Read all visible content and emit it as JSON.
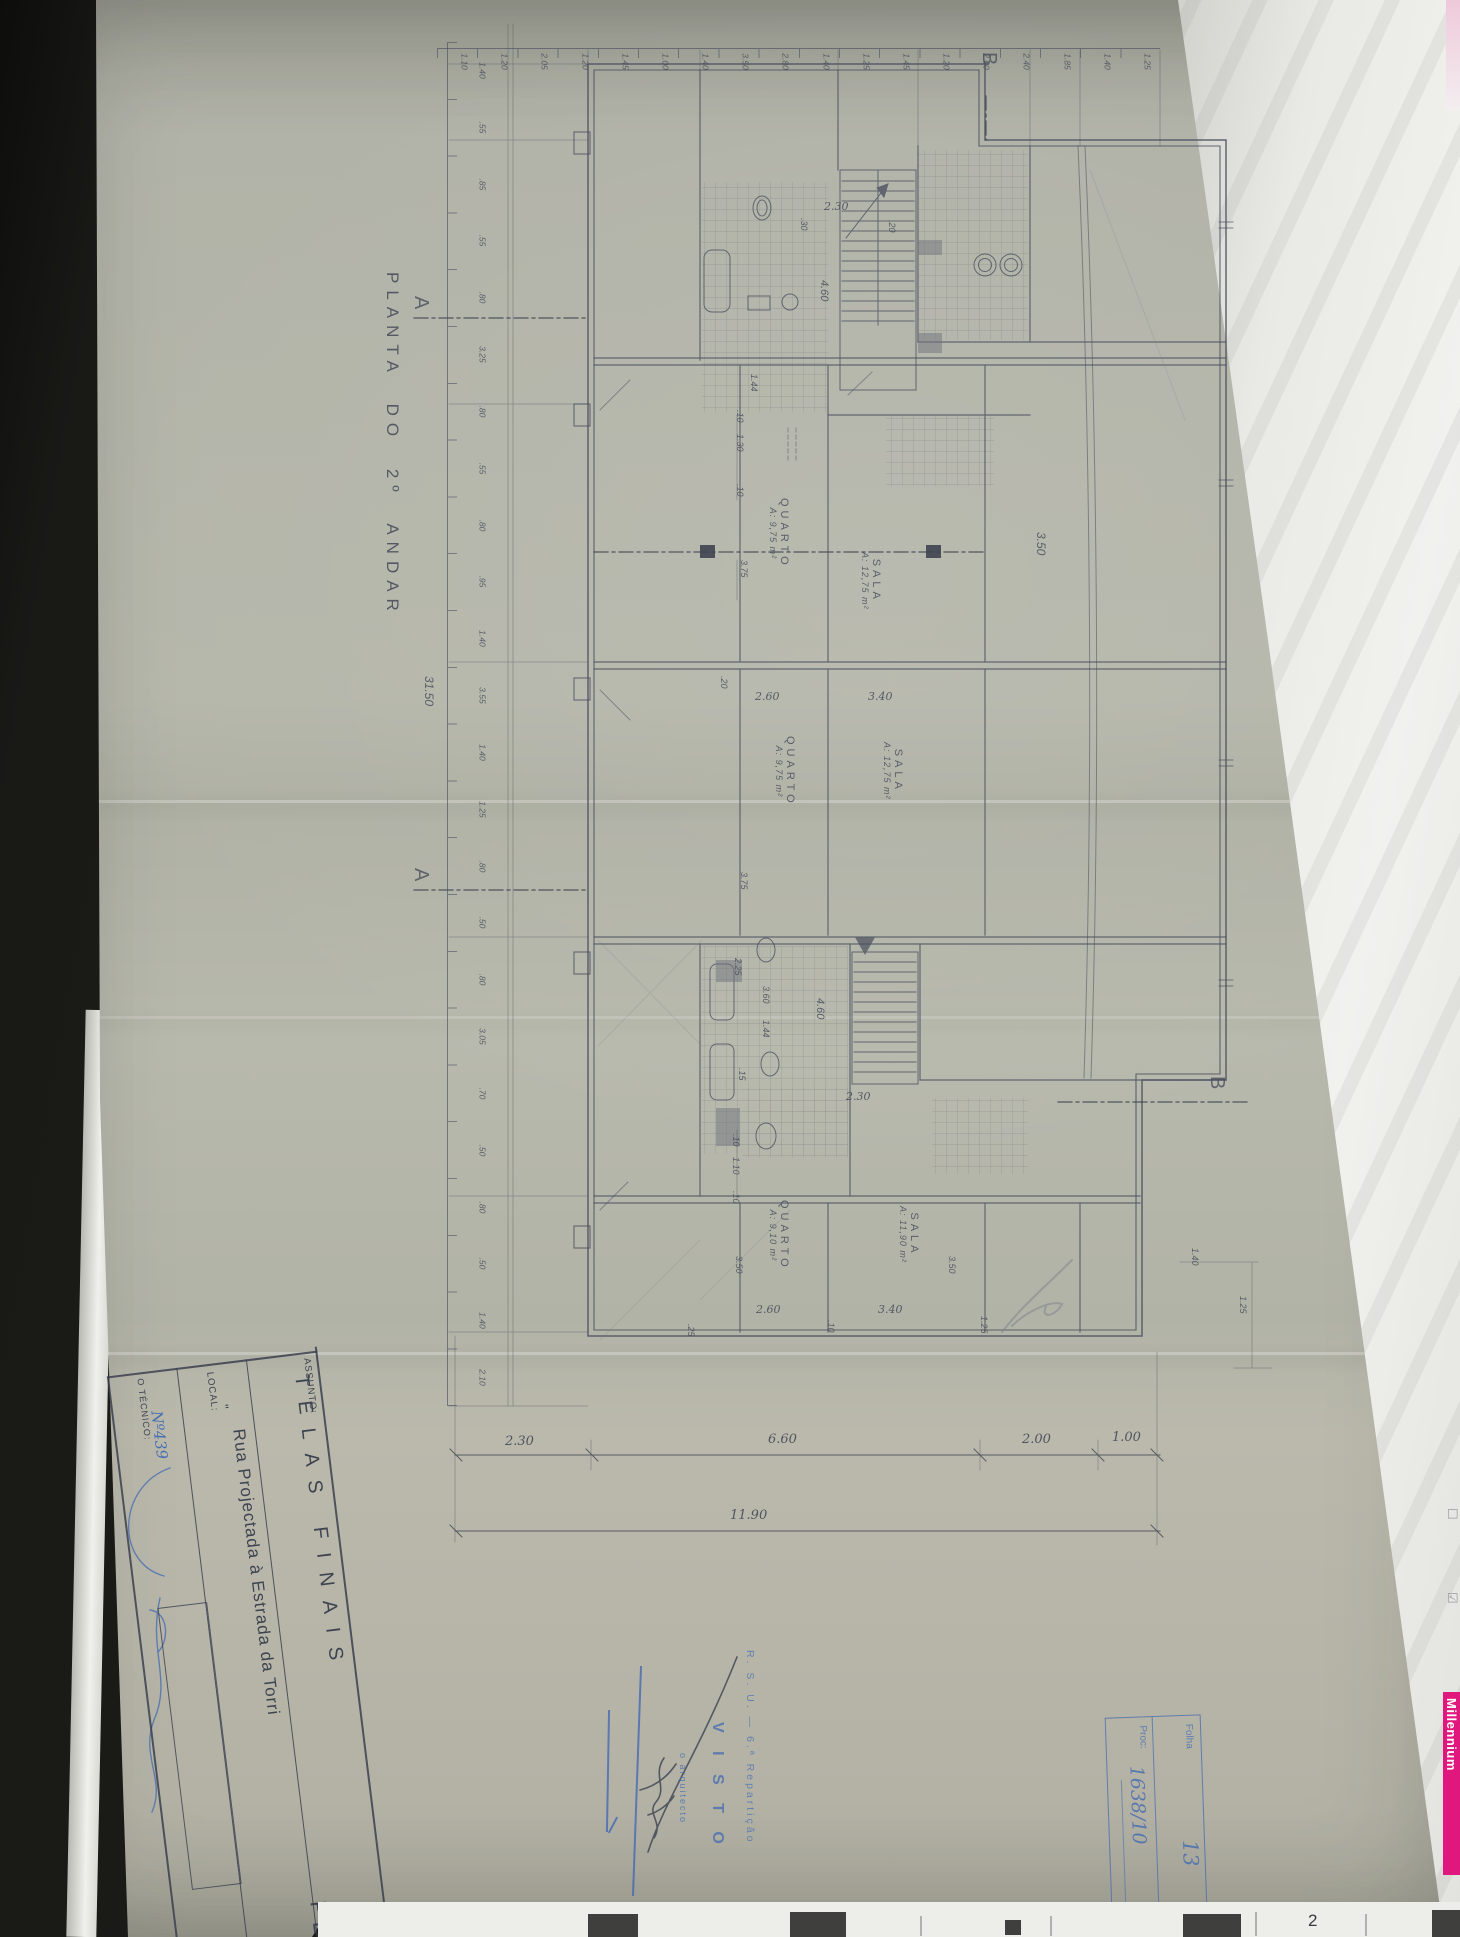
{
  "drawing": {
    "title": "PLANTA DO 2º ANDAR",
    "section_markers": {
      "a1": "A",
      "a2": "A",
      "b1": "B",
      "b2": "B"
    },
    "rooms": {
      "u1_quarto": {
        "name": "QUARTO",
        "area": "A: 9,75 m²"
      },
      "u1_sala": {
        "name": "SALA",
        "area": "A: 12,75 m²"
      },
      "u2_quarto": {
        "name": "QUARTO",
        "area": "A: 9,75 m²"
      },
      "u2_sala": {
        "name": "SALA",
        "area": "A: 12,75 m²"
      },
      "u3_quarto": {
        "name": "QUARTO",
        "area": "A: 9,10 m²"
      },
      "u3_sala": {
        "name": "SALA",
        "area": "A: 11,90 m²"
      }
    },
    "dimensions": {
      "top_chain": [
        "1.10",
        "1.20",
        "2.05",
        "1.20",
        "1.45",
        "1.00",
        "1.40",
        "3.50",
        "2.80",
        "1.40",
        "1.25",
        "1.45",
        "1.20",
        "2.00",
        "2.40",
        "1.85",
        "1.40",
        "1.25"
      ],
      "left_chain": [
        "1.40",
        ".55",
        ".85",
        ".55",
        ".80",
        "3.25",
        ".80",
        ".55",
        ".80",
        ".95",
        "1.40",
        "3.55",
        "1.40",
        "1.25",
        ".80",
        ".50",
        ".80",
        "3.05",
        ".70",
        ".50",
        ".80",
        ".50",
        "1.40",
        "2.10"
      ],
      "left_total": "31.50",
      "bottom_chain": [
        "2.30",
        "6.60",
        "2.00",
        "1.00"
      ],
      "bottom_total": "11.90",
      "right_chain": [
        "1.40",
        "1.25"
      ],
      "misc": [
        "3.75",
        ".10",
        "1.30",
        ".10",
        "2.60",
        "3.40",
        ".20",
        "2.30",
        "4.60",
        "4.60",
        "2.30",
        "2.60",
        "3.40",
        "3.50",
        "3.50",
        ".25",
        ".10",
        "1.25",
        ".10",
        "1.10",
        ".10",
        "2.25",
        "1.44",
        "3.60",
        ".15",
        "1.44",
        "3.50",
        ".30",
        ".20",
        "3.75"
      ]
    }
  },
  "title_block": {
    "assunto_label": "ASSUNTO:",
    "assunto_value": "TELAS FINAIS",
    "local_label": "LOCAL:",
    "local_ditto": "\"",
    "local_value": "Rua Projectada à Estrada da Torri",
    "tecnico_label": "O TÉCNICO:",
    "tecnico_number": "Nº439",
    "corner_label": "PL"
  },
  "stamps": {
    "folha_box": {
      "folha_label": "Folha",
      "proc_label": "Proc:",
      "sheet_number": "13",
      "proc_number": "1638/10"
    },
    "visto": {
      "org": "R. S. U. — 6.ª Repartição",
      "word": "V I S T O",
      "role": "o arquitecto"
    }
  },
  "surroundings": {
    "brand": "Millennium",
    "bottom_digit": "2",
    "icons": {
      "checkbox_empty": "☐",
      "checkbox_checked": "☑"
    }
  }
}
